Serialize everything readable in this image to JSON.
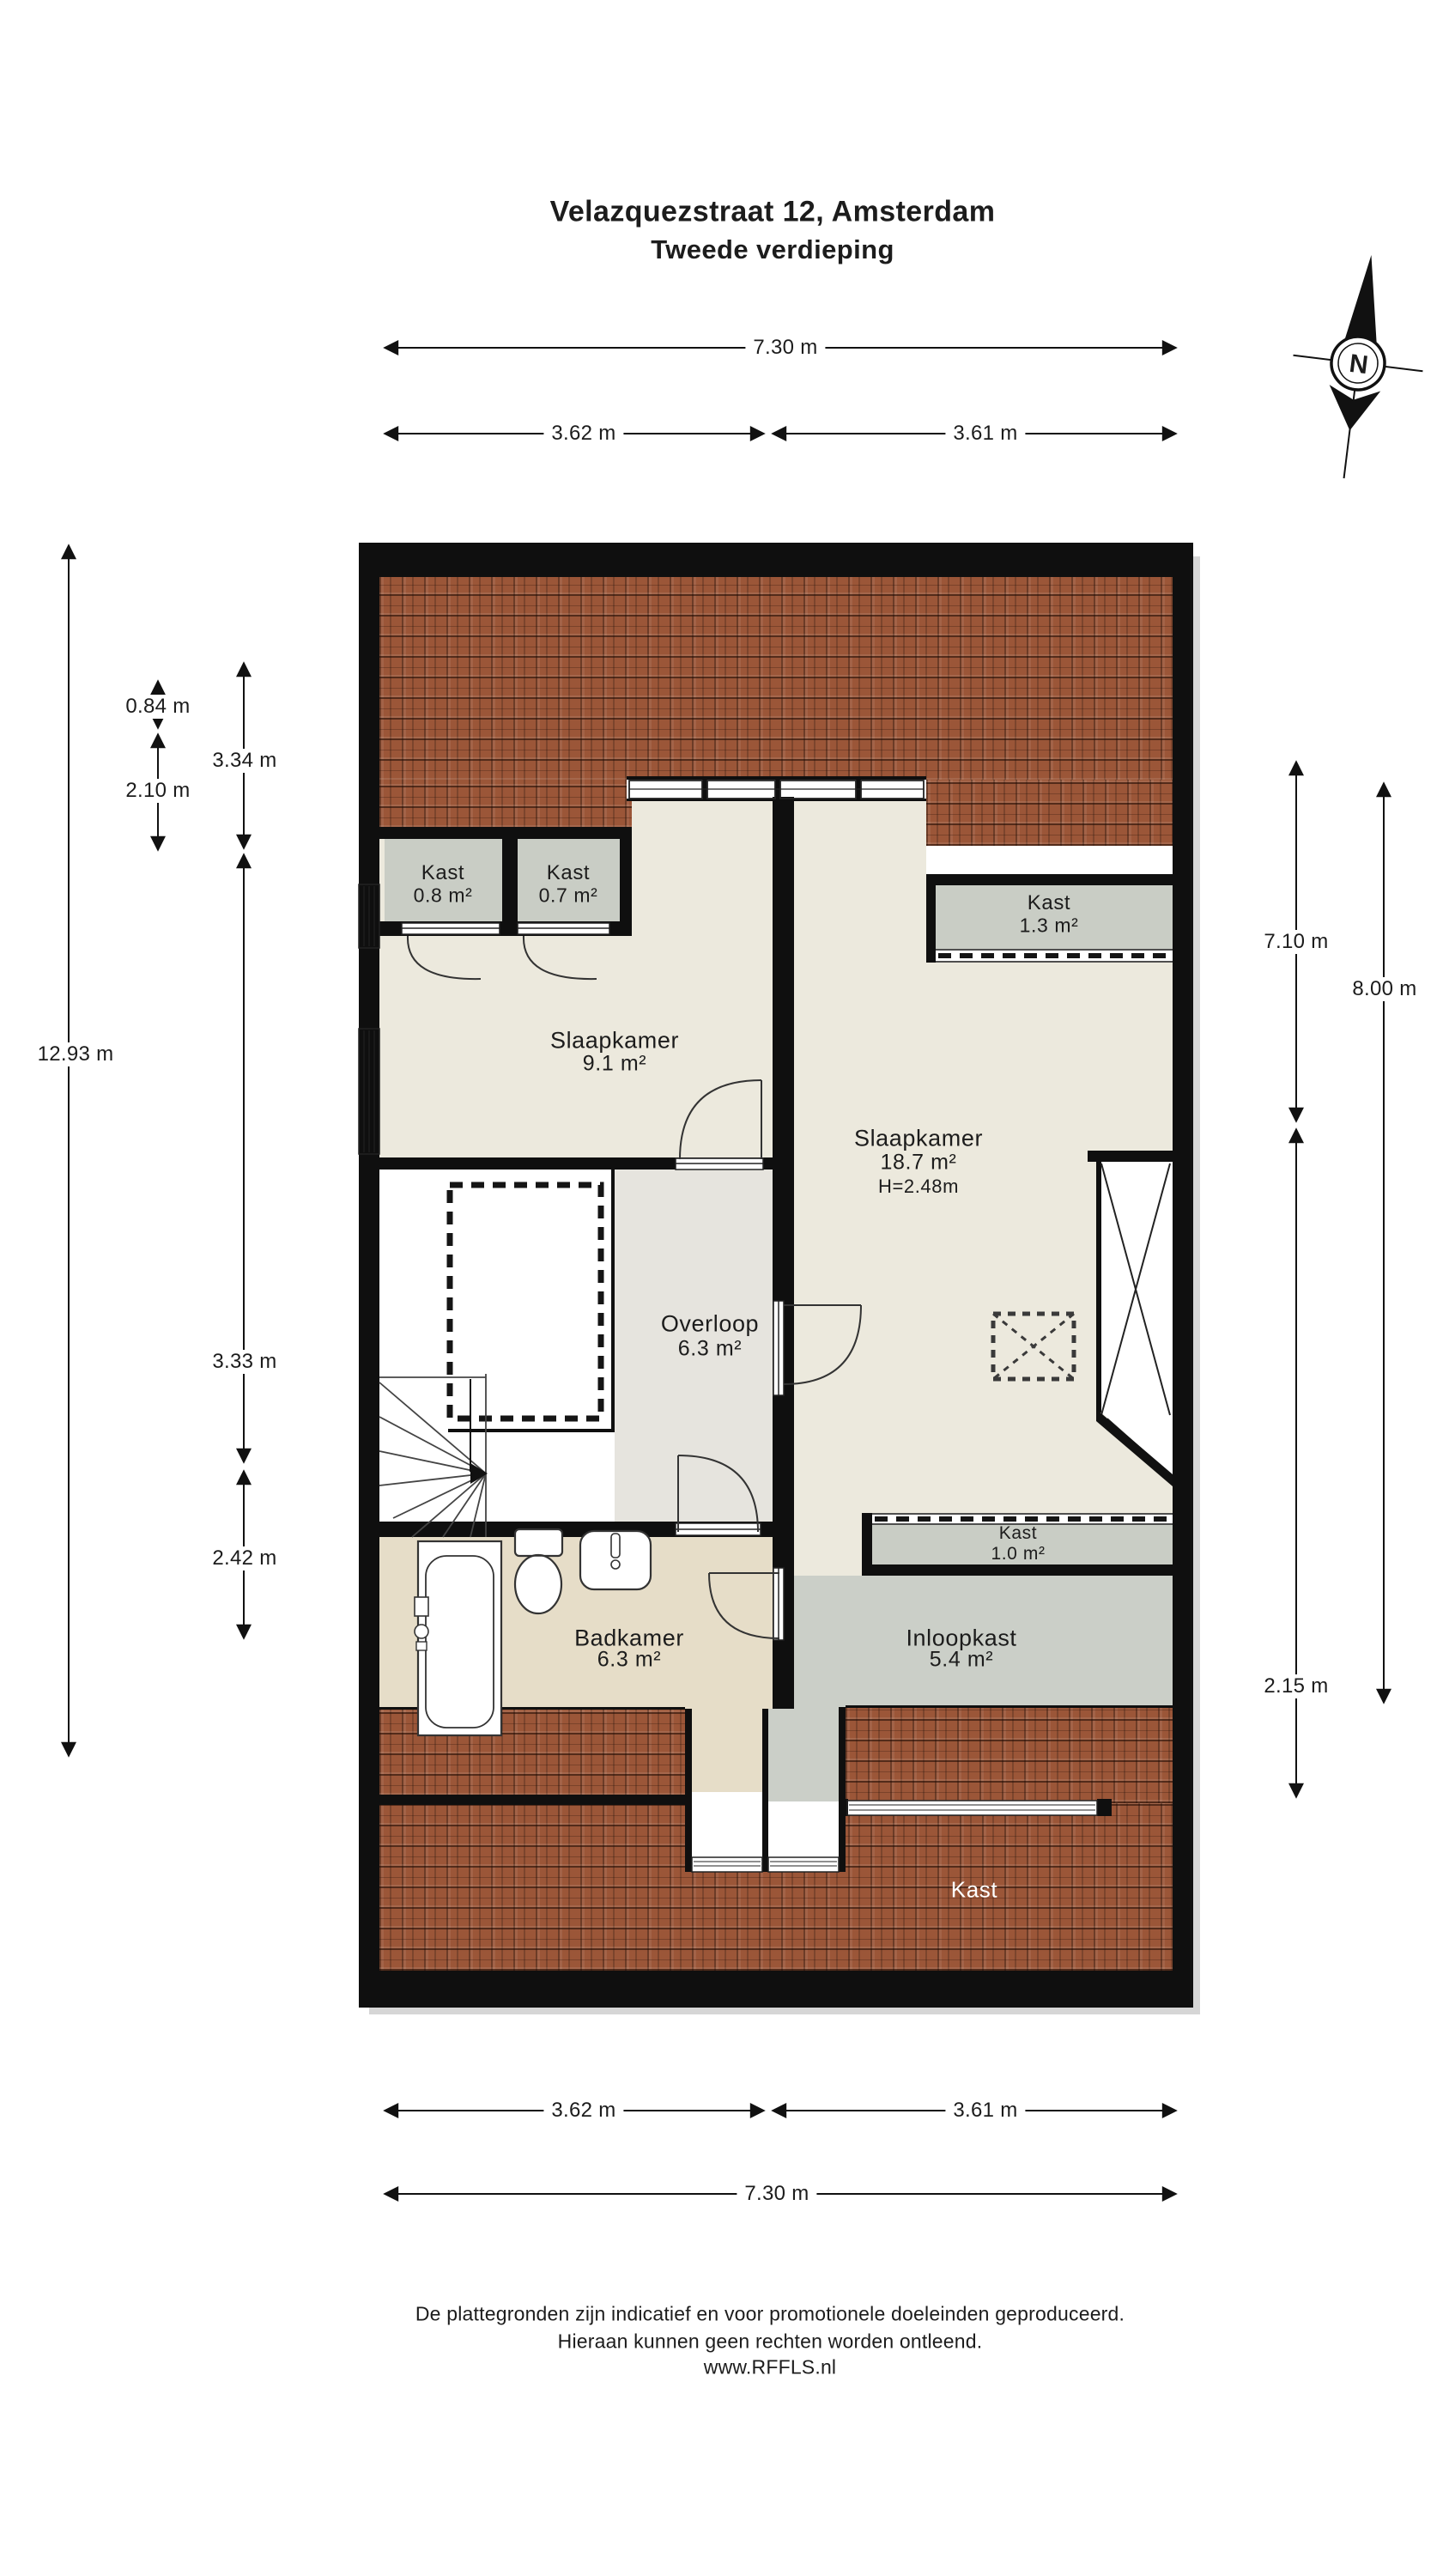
{
  "title": {
    "address": "Velazquezstraat 12, Amsterdam",
    "floor": "Tweede verdieping"
  },
  "compass": {
    "north_label": "N"
  },
  "rooms": {
    "slaapkamer_left": {
      "name": "Slaapkamer",
      "area": "9.1 m²"
    },
    "slaapkamer_right": {
      "name": "Slaapkamer",
      "area": "18.7 m²",
      "ceiling_height": "H=2.48m"
    },
    "overloop": {
      "name": "Overloop",
      "area": "6.3 m²"
    },
    "badkamer": {
      "name": "Badkamer",
      "area": "6.3 m²"
    },
    "inloopkast": {
      "name": "Inloopkast",
      "area": "5.4 m²"
    },
    "kast_top_left": {
      "name": "Kast",
      "area": "0.8 m²"
    },
    "kast_top_middle": {
      "name": "Kast",
      "area": "0.7 m²"
    },
    "kast_top_right": {
      "name": "Kast",
      "area": "1.3 m²"
    },
    "kast_middle": {
      "name": "Kast",
      "area": "1.0 m²"
    },
    "kast_roof": {
      "name": "Kast"
    }
  },
  "dimensions": {
    "width_total": "7.30 m",
    "width_left": "3.62 m",
    "width_right": "3.61 m",
    "height_total_left": "12.93 m",
    "h_084": "0.84 m",
    "h_210": "2.10 m",
    "h_334": "3.34 m",
    "h_333": "3.33 m",
    "h_242": "2.42 m",
    "h_710": "7.10 m",
    "h_800": "8.00 m",
    "h_215": "2.15 m"
  },
  "footer": {
    "line1": "De plattegronden zijn indicatief en voor promotionele doeleinden geproduceerd.",
    "line2": "Hieraan kunnen geen rechten worden ontleend.",
    "line3": "www.RFFLS.nl"
  },
  "colors": {
    "wall": "#0f0f0f",
    "roof_tile": "#9b5638",
    "floor_cream": "#ece9dd",
    "floor_landing": "#e6e4de",
    "floor_bath": "#e6ddc8",
    "floor_closet": "#cbcfc8",
    "background": "#ffffff",
    "kast_roof_label": "#ffffff"
  }
}
